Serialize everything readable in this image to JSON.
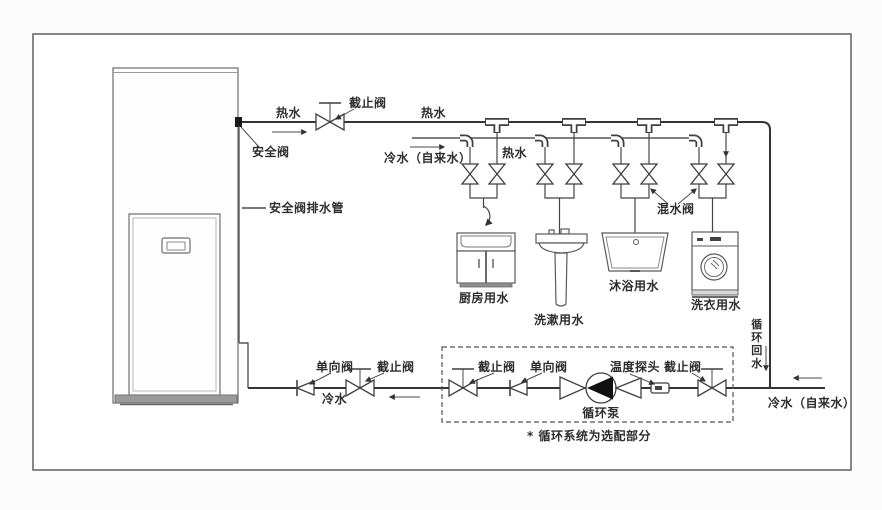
{
  "colors": {
    "pipe_line": "#343434",
    "thin_line": "#555555",
    "text": "#2e2e2e",
    "pump_fill": "#111111",
    "heater_base": "#9a9a9a"
  },
  "labels": {
    "hot_water_out": "热水",
    "stop_valve_main": "截止阀",
    "hot_water_main": "热水",
    "safety_valve": "安全阀",
    "safety_valve_drain": "安全阀排水管",
    "cold_water_supply_top": "冷水（自来水）",
    "hot_water_branch": "热水",
    "mixing_valve": "混水阀",
    "circulation_return": [
      "循",
      "环",
      "回",
      "水"
    ],
    "check_valve_left": "单向阀",
    "stop_valve_left": "截止阀",
    "cold_water_left": "冷水",
    "stop_valve_loop_left": "截止阀",
    "check_valve_loop": "单向阀",
    "temp_probe": "温度探头",
    "stop_valve_loop_right": "截止阀",
    "circulation_pump": "循环泵",
    "cold_water_supply_bottom": "冷水（自来水）",
    "note": "* 循环系统为选配部分"
  },
  "fixtures": [
    {
      "label": "厨房用水"
    },
    {
      "label": "洗漱用水"
    },
    {
      "label": "沐浴用水"
    },
    {
      "label": "洗衣用水"
    }
  ]
}
